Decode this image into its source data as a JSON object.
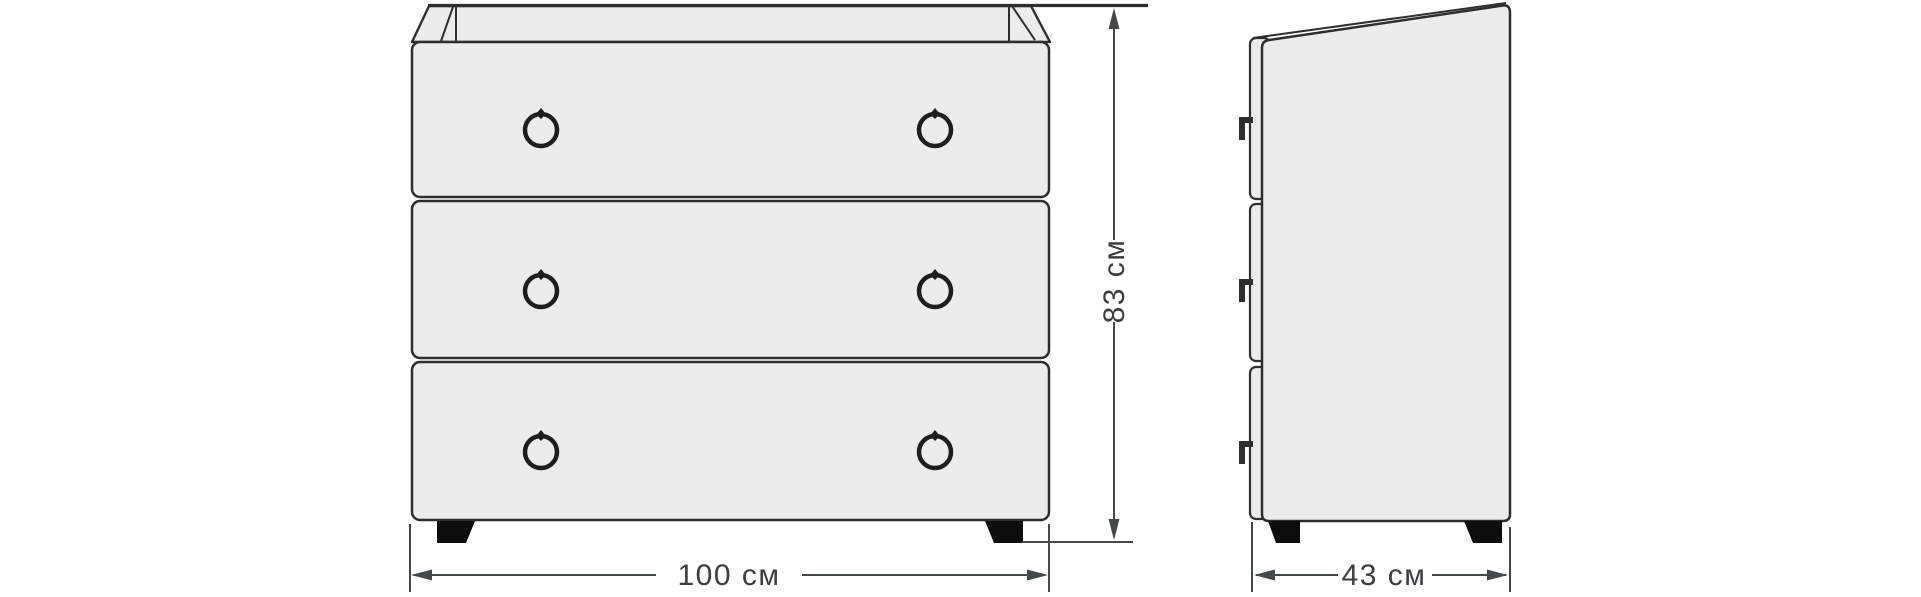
{
  "diagram": {
    "subject": "chest-of-drawers",
    "drawer_count": 3,
    "handles_per_drawer": 2,
    "dimensions": {
      "width": {
        "value": 100,
        "unit": "см",
        "label": "100 см"
      },
      "height": {
        "value": 83,
        "unit": "см",
        "label": "83 см"
      },
      "depth": {
        "value": 43,
        "unit": "см",
        "label": "43 см"
      }
    },
    "colors": {
      "background": "#ffffff",
      "panel_fill": "#ebecec",
      "outline": "#2c2e30",
      "dimension_line": "#43484a",
      "dimension_text": "#3b3f41",
      "feet": "#0d0d0d"
    }
  }
}
